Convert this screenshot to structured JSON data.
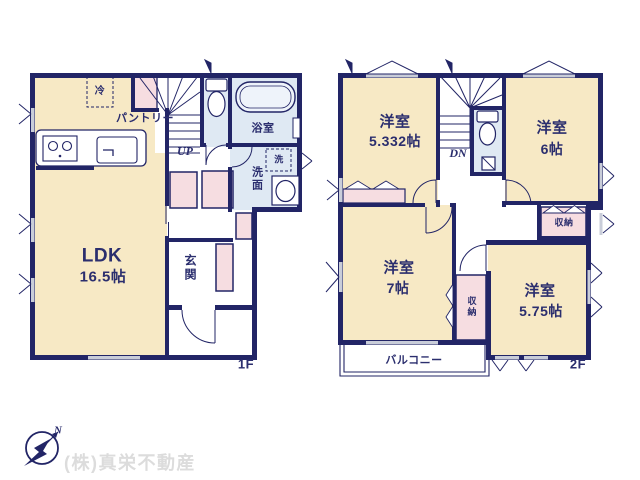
{
  "floor1": {
    "label": "1F",
    "ldk_name": "LDK",
    "ldk_size": "16.5帖",
    "pantry": "パントリー",
    "fridge": "冷",
    "stairs": "UP",
    "bath": "浴室",
    "washer": "洗",
    "washroom": "洗面",
    "entrance": "玄関"
  },
  "floor2": {
    "label": "2F",
    "room_nw_name": "洋室",
    "room_nw_size": "5.332帖",
    "room_ne_name": "洋室",
    "room_ne_size": "6帖",
    "room_sw_name": "洋室",
    "room_sw_size": "7帖",
    "room_se_name": "洋室",
    "room_se_size": "5.75帖",
    "closet_ne": "収納",
    "closet_mid": "収納",
    "stairs": "DN",
    "balcony": "バルコニー"
  },
  "compass_north": "N",
  "company": "(株)真栄不動産",
  "colors": {
    "wall": "#222566",
    "room_cream": "#f7e9c5",
    "closet_pink": "#f6dde1",
    "wet_blue": "#dfe9f3",
    "window_gray": "#c9cdd9",
    "label_navy": "#2b2e6e",
    "company_gray": "#dcdcdc"
  }
}
